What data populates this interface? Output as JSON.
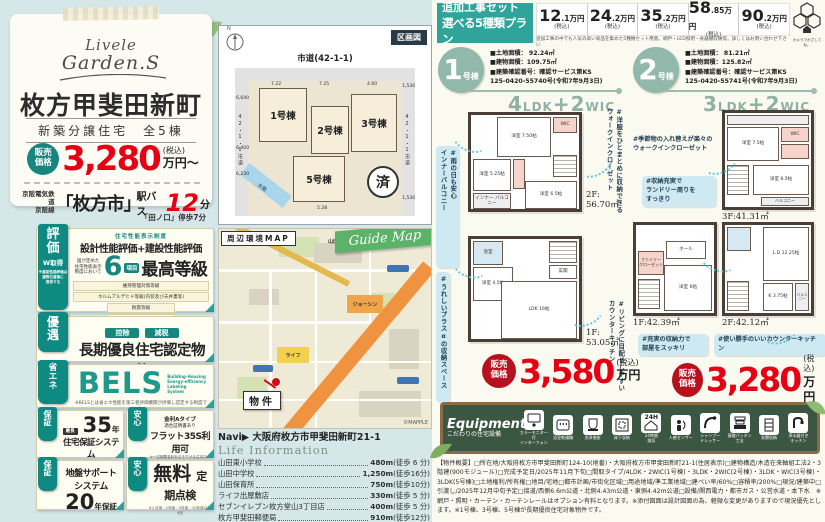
{
  "hero": {
    "logo1": "Livele",
    "logo2": "Garden.S",
    "title": "枚方甲斐田新町",
    "subtitle": "新築分譲住宅　全5棟",
    "price_label": "販売\n価格",
    "price": "3,280",
    "tax": "(税込)",
    "unit": "万円〜",
    "rail": "京阪電気鉄道\n京阪線",
    "station": "「枚方市」",
    "bus": "駅バス",
    "minutes": "12",
    "min_unit": "分",
    "walk_note": "「田ノ口」停歩7分"
  },
  "perf": {
    "tab": "評\n価",
    "tab_sub": "W取得",
    "side_note": "※建設性能評価は\n建物引渡後に\n取得する",
    "small_top": "住宅性能表示制度",
    "headline": "設計性能評価+建設性能評価",
    "pre": "国が定めた\n住宅性能表示\n制度において",
    "num": "6",
    "num_unit": "項目",
    "grade": "最高等級",
    "rows": [
      "維持管理対策等級",
      "ホルムアルデヒド等級(内装及び天井裏等)",
      "耐震等級",
      "劣化対策等級",
      "耐震等級(構造躯体の倒壊等防止)",
      "耐震等級(構造躯体の損傷防止)"
    ]
  },
  "yugu": {
    "tab": "優\n遇",
    "pill1": "控除",
    "pill2": "減税",
    "title": "長期優良住宅認定物件",
    "note": "※一部の建物は対象外の場合がございます。"
  },
  "bels": {
    "tab": "省\nエ\nネ",
    "big": "BELS",
    "sub": "Building-Housing\nEnergy-efficiency\nLabeling\nSystem",
    "note": "※BELSとは省エネ性能を第三者評価機関が評価し認定する制度です。"
  },
  "hosho": {
    "tab": "保\n証",
    "pre": "最長",
    "num": "35",
    "unit": "年",
    "title": "住宅保証システム",
    "note": "お引渡しから10年毎、5年ごとに\n有償補修工事を行うことが条件となります。"
  },
  "flat": {
    "tab": "安\n心",
    "l1": "金利Aタイプ",
    "l2": "適合証明書あり",
    "title": "フラット35S利用可",
    "note": "※一定期間金利を引き下げる住宅ローン\n「フラット35S」をご利用いただけます。"
  },
  "jiban": {
    "tab": "保\n証",
    "title": "地盤サポート\nシステム",
    "num": "20",
    "unit": "年保証"
  },
  "teiki": {
    "tab": "安\n心",
    "big": "無料",
    "title": "定期点検",
    "note": "6ヶ月後・2年後・5年後・10年後の計4回"
  },
  "siteplan": {
    "corner": "区画図",
    "north": "N",
    "road_top": "市道(42-1-1)",
    "lot1": "1号棟",
    "lot2": "2号棟",
    "lot3": "3号棟",
    "lot5": "5号棟",
    "sold": "済",
    "water": "水路",
    "dim_l1": "6,640",
    "dim_l2": "6,400",
    "dim_l3": "6,230",
    "dim_t1": "7.22",
    "dim_t2": "7.25",
    "dim_t3": "4.60",
    "dim_r1": "1,530",
    "dim_r2": "1,530",
    "dim_b": "5.28",
    "road_left": "42・1・1市道",
    "road_right": "42・1・1市道"
  },
  "map": {
    "label": "周辺環境MAP",
    "ribbon": "Guide Map",
    "marker": "物件",
    "credit": "©MAPPLE",
    "poi1": "ジョーシン",
    "poi2": "ライフ",
    "poi3": "山田東小",
    "navi": "Navi▶ 大阪府枚方市甲斐田新町21-1"
  },
  "life": {
    "title": "Life Information",
    "items": [
      {
        "name": "山田東小学校",
        "dist": "480m",
        "walk": "(徒歩 6 分)"
      },
      {
        "name": "山田中学校",
        "dist": "1,250m",
        "walk": "(徒歩16分)"
      },
      {
        "name": "山田保育所",
        "dist": "750m",
        "walk": "(徒歩10分)"
      },
      {
        "name": "ライフ出屋敷店",
        "dist": "330m",
        "walk": "(徒歩 5 分)"
      },
      {
        "name": "セブンイレブン枚方堂山3丁目店",
        "dist": "400m",
        "walk": "(徒歩 5 分)"
      },
      {
        "name": "枚方甲斐田郵便局",
        "dist": "910m",
        "walk": "(徒歩12分)"
      }
    ]
  },
  "addon": {
    "t1": "追加工事セット",
    "t2": "選べる5種類プラン",
    "prices": [
      {
        "n": "12",
        "d": ".1万円",
        "t": "(税込)"
      },
      {
        "n": "24",
        "d": ".2万円",
        "t": "(税込)"
      },
      {
        "n": "35",
        "d": ".2万円",
        "t": "(税込)"
      },
      {
        "n": "58",
        "d": ".85万円",
        "t": "(税込)"
      },
      {
        "n": "90",
        "d": ".2万円",
        "t": "(税込)"
      }
    ],
    "note": "追加工事の中でも人気の高い商品を集めた5種類セット用意。網戸・LED照明・食器棚収納等。詳しくはお問い合わせ下さい",
    "logo_caption": "カメラでかざしてね。"
  },
  "b1": {
    "no": "1",
    "suffix": "号棟",
    "spec1": "■土地面積： 92.24㎡",
    "spec2": "■建物面積：109.75㎡",
    "spec3": "■建築確認番号：確認サービス第KS",
    "spec4": "125-0420-55740号(令和7年9月3日)",
    "l1": "4",
    "l2": "LDK",
    "l3": "+",
    "l4": "2",
    "l5": "WIC",
    "f2_label": "2F:\n56.70㎡",
    "f1_label": "1F:\n53.05㎡",
    "rooms2": [
      "洋室\n7.50帖",
      "洋室\n5.25帖",
      "洋室\n6.5帖",
      "インナー\nバルコニー",
      "WIC"
    ],
    "rooms1": [
      "洋室\n4.5帖",
      "LDK\n16帖",
      "浴室",
      "玄関"
    ],
    "tag1": "#雨の日も安心\nインナーバルコニー",
    "tag2": "#洋服をひとまとめに収納できる\nウォークインクローゼット",
    "tag3": "#うれしいプラスαの収納スペース",
    "tag4": "#リビングに目配せしやすい\nカウンターキッチン",
    "price_label": "販売\n価格",
    "price": "3,580",
    "tax": "(税込)",
    "unit": "万円"
  },
  "b2": {
    "no": "2",
    "suffix": "号棟",
    "spec1": "■土地面積： 81.21㎡",
    "spec2": "■建物面積：125.82㎡",
    "spec3": "■建築確認番号：確認サービス第KS",
    "spec4": "125-0420-55741号(令和7年9月3日)",
    "l1": "3",
    "l2": "LDK",
    "l3": "+",
    "l4": "2",
    "l5": "WIC",
    "f3_label": "3F:41.31㎡",
    "f1_label": "1F:42.39㎡",
    "f2_label": "2F:42.12㎡",
    "rooms3": [
      "洋室\n7.5帖",
      "洋室\n8.5帖",
      "WIC",
      "バルコニー"
    ],
    "rooms1": [
      "洋室\n6帖",
      "ファミリー\nクローゼット",
      "ホール"
    ],
    "rooms2": [
      "L.D\n12.25帖",
      "K\n3.75帖",
      "バルコニー"
    ],
    "tag1": "#季節物の入れ替えが楽々の\nウォークインクローゼット",
    "tag2": "#収納充実で\nランドリー周りを\nすっきり",
    "tag3": "#充実の収納力で\n部屋をスッキリ",
    "tag4": "#使い勝手のいいカウンターキッチン",
    "price_label": "販売\n価格",
    "price": "3,280",
    "tax": "(税込)",
    "unit": "万円"
  },
  "equipment": {
    "title": "Equipment",
    "subtitle": "こだわりの住宅設備",
    "badge_24h": "24H",
    "items": [
      "カラーモニター付\nインターフォン",
      "浴室乾燥機",
      "洗浄便座",
      "床下収納",
      "24時間\n換気",
      "人感センサー",
      "シャンプー\nドレッサー",
      "基礎パッキン\n工法",
      "玄関収納",
      "浄水器付き\nキッチン"
    ]
  },
  "outline": "【物件概要】□所在地/大阪府枚方市甲斐田新町124-10(地番)・大阪府枚方市甲斐田新町21-1(住居表示)□建物構造/木造在来軸組工法2・3階建(900モジュール)□完成予定日/2025年11月下旬□間取タイプ/4LDK・2WIC(1号棟)・3LDK・2WIC(2号棟)・3LDK・WIC(3号棟)・3LDK(5号棟)□土地権利/所有権□地目/宅地□都市計画/市街化区域□用途地域/準工業地域□建ぺい率/60%□容積率/200%□現況/建築中□引渡し/2025年12月中旬予定□接道/西側6.6m公道・北側4.43m公道・東側4.42m公道□設備/関西電力・都市ガス・公営水道・本下水　※網戸・照明・カーテン・カーテンレールはオプション有料となります。※添付図面は設計図面の為、軽微な変更がありますので現況優先とします。※1号棟、3号棟、5号棟が長期優良住宅対象物件です。"
}
